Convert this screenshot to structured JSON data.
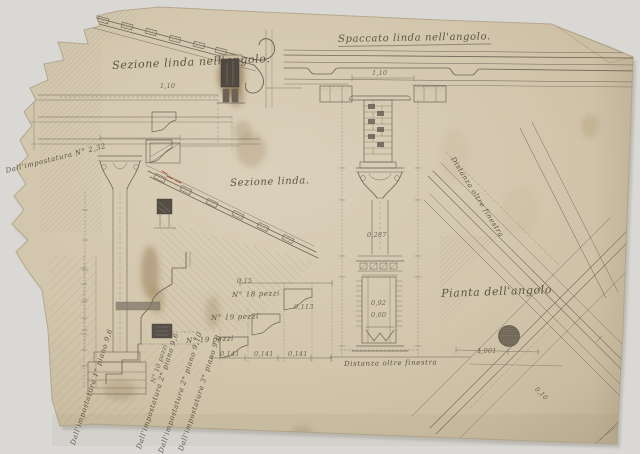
{
  "labels": {
    "section_corner": "Sezione linda nell'angolo.",
    "soffit_corner": "Spaccato linda nell'angolo.",
    "section": "Sezione linda.",
    "plan_corner": "Pianta dell'angolo",
    "distance_diag": "Distanza oltre finestra",
    "distance_bottom": "Distanza oltre finestra",
    "impost_left_edge": "Dall'impostatura N° 2,32",
    "impost_1": "Dall'impostatura 1° piano 9,6",
    "impost_2": "Dall'impostatura 2° piano 9,6",
    "impost_3": "Dall'impostatura 2° piano 9,10",
    "impost_4": "Dall'impostatura 3° piano 9,8"
  },
  "annotations": {
    "pieces_18": "N° 18 pezzi",
    "pieces_19a": "N° 19 pezzi",
    "pieces_19b": "N° 19 pezzi",
    "pieces_10": "N° 10 pezzi"
  },
  "dimensions": {
    "d1": "1,10",
    "d2": "0,287",
    "d3": "0,92",
    "d4": "0,60",
    "d5": "0,141",
    "d6": "0,141",
    "d7": "0,141",
    "d8": "0,15",
    "d9": "0,113",
    "d10": "1,10",
    "d11": "1,001",
    "d12": "0,10"
  },
  "colors": {
    "backdrop": "#d9d8d4",
    "paper": "#d2c6ad",
    "paper_edge": "#b5a88c",
    "ink": "#6f6557",
    "ink_dark": "#4f4941",
    "stain": "#8a6a3c",
    "accent_red": "#a8503a"
  }
}
